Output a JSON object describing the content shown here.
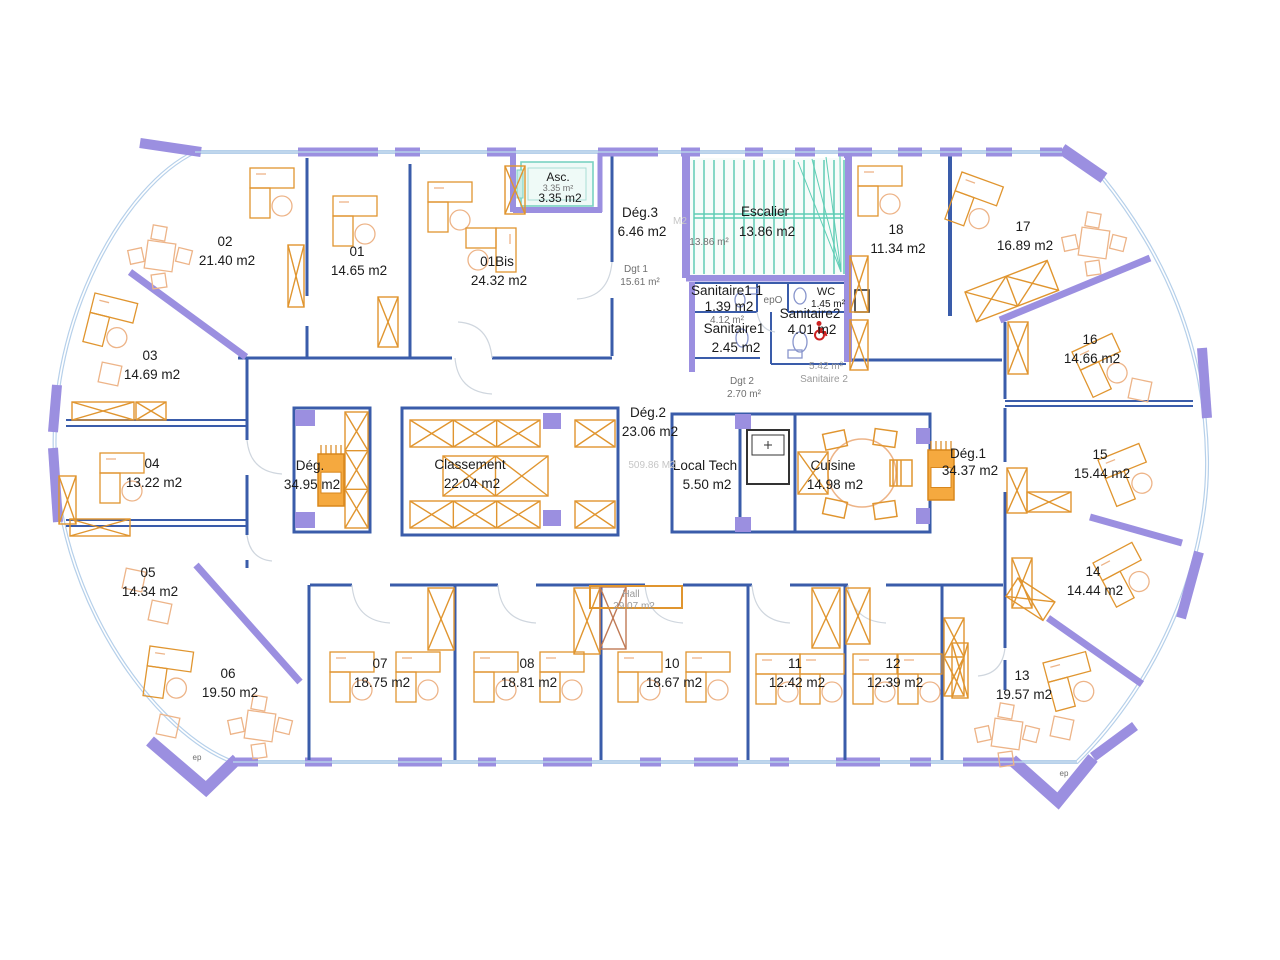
{
  "plan": {
    "title": "Office floor plan",
    "colors": {
      "wall": "#9b8fe0",
      "partition": "#3a5caa",
      "glass": "#b6d0ea",
      "furniture": "#e0952f",
      "furniture_light": "#edb488",
      "stairs": "#5fcdb5",
      "text": "#1b1b1b",
      "text_dim": "#6f6f6f",
      "text_gray": "#9a9a9a",
      "text_faint": "#c6c6c6",
      "accent_red": "#cc2222"
    },
    "rooms": [
      {
        "name": "02",
        "area": "21.40 m2",
        "x": 225,
        "y": 246
      },
      {
        "name": "01",
        "area": "14.65 m2",
        "x": 357,
        "y": 256
      },
      {
        "name": "01Bis",
        "area": "24.32 m2",
        "x": 497,
        "y": 266
      },
      {
        "name": "03",
        "area": "14.69 m2",
        "x": 150,
        "y": 360
      },
      {
        "name": "04",
        "area": "13.22 m2",
        "x": 152,
        "y": 468
      },
      {
        "name": "05",
        "area": "14.34 m2",
        "x": 148,
        "y": 577
      },
      {
        "name": "06",
        "area": "19.50 m2",
        "x": 228,
        "y": 678
      },
      {
        "name": "07",
        "area": "18.75 m2",
        "x": 380,
        "y": 668
      },
      {
        "name": "08",
        "area": "18.81 m2",
        "x": 527,
        "y": 668
      },
      {
        "name": "10",
        "area": "18.67 m2",
        "x": 672,
        "y": 668
      },
      {
        "name": "11",
        "area": "12.42 m2",
        "x": 795,
        "y": 668
      },
      {
        "name": "12",
        "area": "12.39 m2",
        "x": 893,
        "y": 668
      },
      {
        "name": "13",
        "area": "19.57 m2",
        "x": 1022,
        "y": 680
      },
      {
        "name": "14",
        "area": "14.44 m2",
        "x": 1093,
        "y": 576
      },
      {
        "name": "15",
        "area": "15.44 m2",
        "x": 1100,
        "y": 459
      },
      {
        "name": "16",
        "area": "14.66 m2",
        "x": 1090,
        "y": 344
      },
      {
        "name": "17",
        "area": "16.89 m2",
        "x": 1023,
        "y": 231
      },
      {
        "name": "18",
        "area": "11.34 m2",
        "x": 896,
        "y": 234
      },
      {
        "name": "Escalier",
        "area": "13.86 m2",
        "x": 765,
        "y": 216,
        "dy": 20
      },
      {
        "name": "Dég.3",
        "area": "6.46 m2",
        "x": 640,
        "y": 217
      },
      {
        "name": "Dég.",
        "area": "34.95 m2",
        "x": 310,
        "y": 470
      },
      {
        "name": "Classement",
        "area": "22.04 m2",
        "x": 470,
        "y": 469
      },
      {
        "name": "Dég.2",
        "area": "23.06 m2",
        "x": 648,
        "y": 417
      },
      {
        "name": "Local Tech",
        "area": "5.50 m2",
        "x": 705,
        "y": 470
      },
      {
        "name": "Cuisine",
        "area": "14.98 m2",
        "x": 833,
        "y": 470
      },
      {
        "name": "Dég.1",
        "area": "34.37 m2",
        "x": 968,
        "y": 458,
        "dy": 17
      },
      {
        "name": "Asc.",
        "area": "3.35 m2",
        "x": 558,
        "y": 181,
        "size": 12,
        "dy": 21
      },
      {
        "name": "WC",
        "area": "1.45 m²",
        "x": 826,
        "y": 295,
        "size": 11,
        "dy": 12,
        "asize": 10
      },
      {
        "name": "Sanitaire1 1",
        "area": "1.39 m2",
        "x": 727,
        "y": 295,
        "dy": 16
      },
      {
        "name": "Sanitaire1",
        "area": "2.45 m2",
        "x": 734,
        "y": 333
      },
      {
        "name": "Sanitaire2",
        "area": "4.01 m2",
        "x": 810,
        "y": 318,
        "dy": 16
      }
    ],
    "annotations": [
      {
        "text": "3.35 m²",
        "x": 558,
        "y": 191,
        "size": 9,
        "color": "dim"
      },
      {
        "text": "13.86 m²",
        "x": 709,
        "y": 245,
        "size": 10,
        "color": "dim"
      },
      {
        "text": "Dgt 1",
        "x": 636,
        "y": 272,
        "size": 10,
        "color": "dim"
      },
      {
        "text": "15.61 m²",
        "x": 640,
        "y": 285,
        "size": 10,
        "color": "dim"
      },
      {
        "text": "4.12 m²",
        "x": 727,
        "y": 323,
        "size": 10,
        "color": "dim"
      },
      {
        "text": "Dgt 2",
        "x": 742,
        "y": 384,
        "size": 10,
        "color": "dim"
      },
      {
        "text": "2.70 m²",
        "x": 744,
        "y": 397,
        "size": 10,
        "color": "dim"
      },
      {
        "text": "5.42 m²",
        "x": 826,
        "y": 369,
        "size": 10,
        "color": "gray"
      },
      {
        "text": "Sanitaire 2",
        "x": 824,
        "y": 382,
        "size": 10,
        "color": "gray"
      },
      {
        "text": "epO",
        "x": 773,
        "y": 303,
        "size": 10,
        "color": "dim"
      },
      {
        "text": "509.86 M2",
        "x": 652,
        "y": 468,
        "size": 10,
        "color": "faint"
      },
      {
        "text": "Hall",
        "x": 631,
        "y": 597,
        "size": 10,
        "color": "gray"
      },
      {
        "text": "29.07 m2",
        "x": 634,
        "y": 609,
        "size": 10,
        "color": "gray"
      },
      {
        "text": "M2",
        "x": 680,
        "y": 224,
        "size": 10,
        "color": "faint"
      },
      {
        "text": "ep",
        "x": 197,
        "y": 760,
        "size": 8,
        "color": "dim"
      },
      {
        "text": "ep",
        "x": 1064,
        "y": 776,
        "size": 8,
        "color": "dim"
      }
    ],
    "symbols": [
      {
        "name": "wheelchair-icon",
        "x": 813,
        "y": 321,
        "color": "#cc2222"
      }
    ]
  }
}
